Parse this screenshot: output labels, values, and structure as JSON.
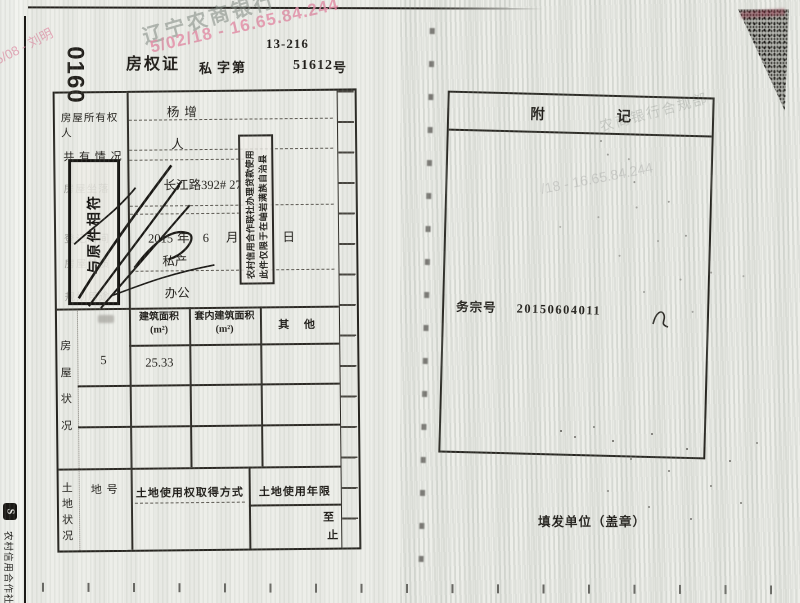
{
  "watermarks": {
    "bank_top": "辽宁农商银行",
    "pink_top": "5/02/18 - 16.65.84.244",
    "pink_left": "5/08 - 刘明",
    "right_dept": "农商银行合规部",
    "right_ip": "/18 - 16.65.84.244"
  },
  "header": {
    "code": "13-216",
    "book_no": "0160",
    "title": "房权证",
    "category": "私",
    "zidi": "字第",
    "serial": "51612",
    "unit": "号"
  },
  "table": {
    "owner_label": "房屋所有权人",
    "owner_value": "杨增",
    "co_label": "共 有 情 况",
    "co_value": "人",
    "location_label": "房屋坐落",
    "location_value": "长江路392# 27",
    "date_label": "登记时间",
    "date_year": "2015",
    "y_unit": "年",
    "date_month": "6",
    "m_unit": "月",
    "d_unit": "日",
    "nature_label": "房屋性质",
    "nature_value": "私产",
    "use_label": "规划用途",
    "use_value": "办公",
    "grid": {
      "col1": "建筑面积",
      "col1_unit": "(m²)",
      "col2": "套内建筑面积",
      "col2_unit": "(m²)",
      "col3": "其  他",
      "floors": "5",
      "area": "25.33"
    },
    "house_chars": [
      "房",
      "屋",
      "状",
      "况"
    ],
    "land_chars": [
      "土",
      "地",
      "状",
      "况"
    ],
    "land": {
      "parcel": "地 号",
      "acquire": "土地使用权取得方式",
      "term": "土地使用年限",
      "zhi_from": "至",
      "zhi_to": "止"
    }
  },
  "stamps": {
    "restrict1": "此件仅限于在岫岩满族自治县",
    "restrict2": "农村信用合作联社办理贷款使用",
    "copy": "与原件相符"
  },
  "right_page": {
    "fu": "附",
    "ji": "记",
    "file_label": "务宗号",
    "file_no": "20150604011",
    "issuer": "填发单位（盖章）"
  },
  "edge": {
    "logo": "S",
    "text": "农村信用合作社"
  }
}
